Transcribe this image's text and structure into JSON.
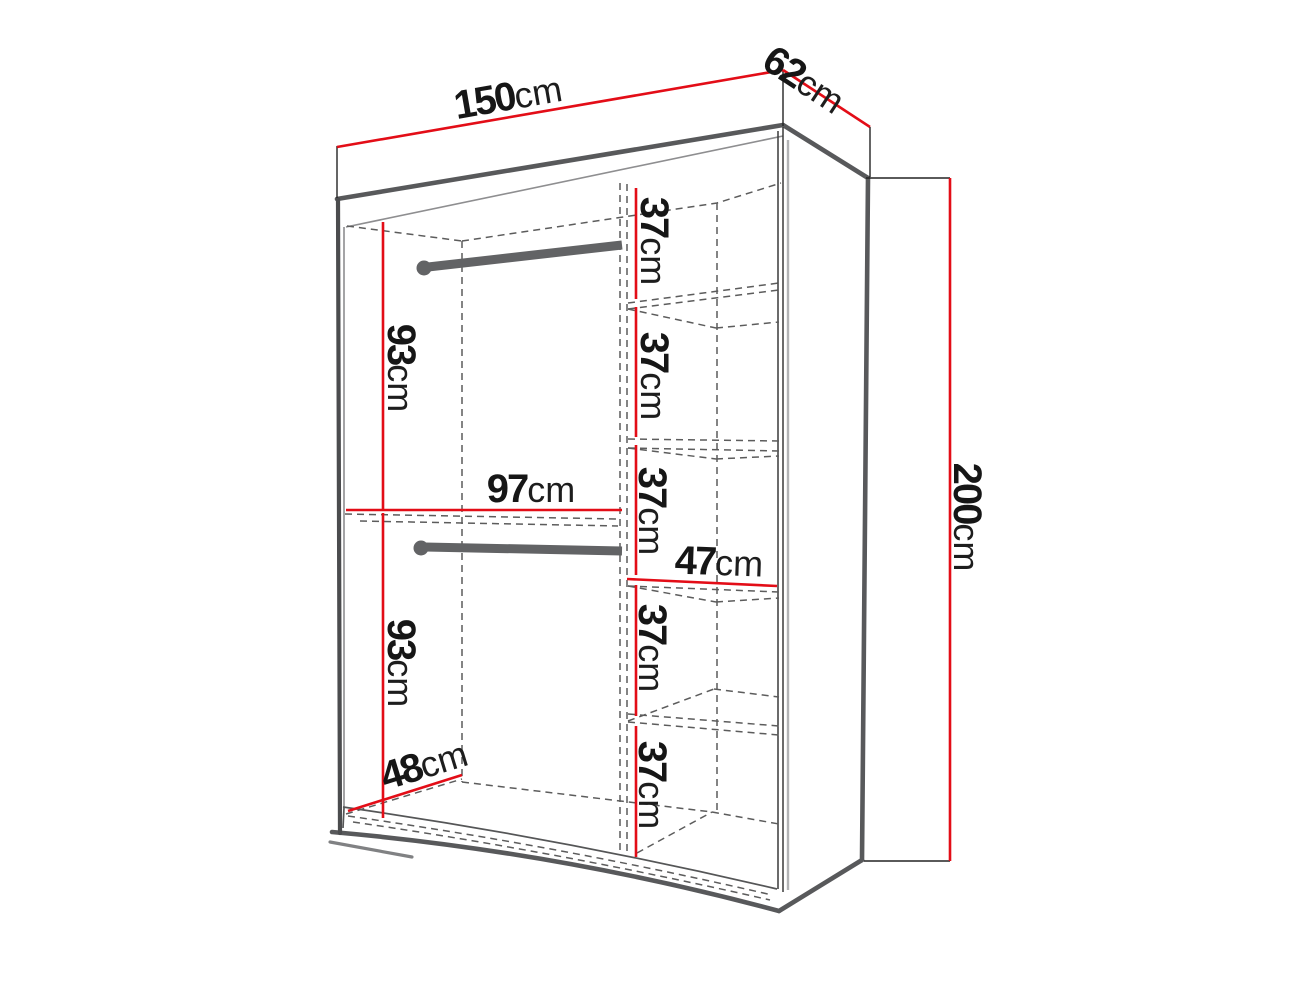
{
  "diagram": {
    "title": "wardrobe-dimension-diagram",
    "background_color": "#ffffff",
    "colors": {
      "dimension_line": "#e30d17",
      "body_edge": "#58595b",
      "hidden_edge": "#5c5c5c",
      "label_text": "#161616"
    },
    "overall": {
      "width": {
        "value": "150",
        "unit": "cm"
      },
      "depth": {
        "value": "62",
        "unit": "cm"
      },
      "height": {
        "value": "200",
        "unit": "cm"
      }
    },
    "interior": {
      "left_upper_height": {
        "value": "93",
        "unit": "cm"
      },
      "left_width": {
        "value": "97",
        "unit": "cm"
      },
      "left_lower_height": {
        "value": "93",
        "unit": "cm"
      },
      "floor_depth": {
        "value": "48",
        "unit": "cm"
      },
      "shelf_width": {
        "value": "47",
        "unit": "cm"
      },
      "shelf_spacing_1": {
        "value": "37",
        "unit": "cm"
      },
      "shelf_spacing_2": {
        "value": "37",
        "unit": "cm"
      },
      "shelf_spacing_3": {
        "value": "37",
        "unit": "cm"
      },
      "shelf_spacing_4": {
        "value": "37",
        "unit": "cm"
      },
      "shelf_spacing_5": {
        "value": "37",
        "unit": "cm"
      }
    }
  }
}
